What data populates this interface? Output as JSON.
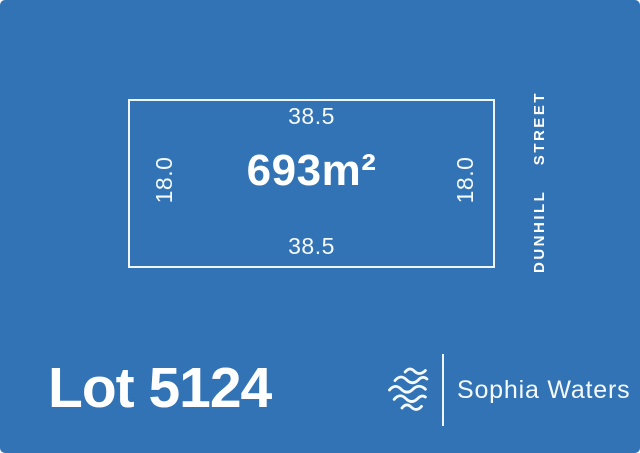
{
  "canvas": {
    "background_color": "#3273B5",
    "foreground_color": "#FFFFFF"
  },
  "lot_plan": {
    "area_label": "693m²",
    "top_dimension": "38.5",
    "bottom_dimension": "38.5",
    "left_dimension": "18.0",
    "right_dimension": "18.0"
  },
  "street": {
    "name": "DUNHILL",
    "type": "STREET",
    "full": "DUNHILL STREET"
  },
  "footer": {
    "lot_title": "Lot 5124",
    "brand_name": "Sophia Waters",
    "logo_icon": "waves-icon"
  }
}
